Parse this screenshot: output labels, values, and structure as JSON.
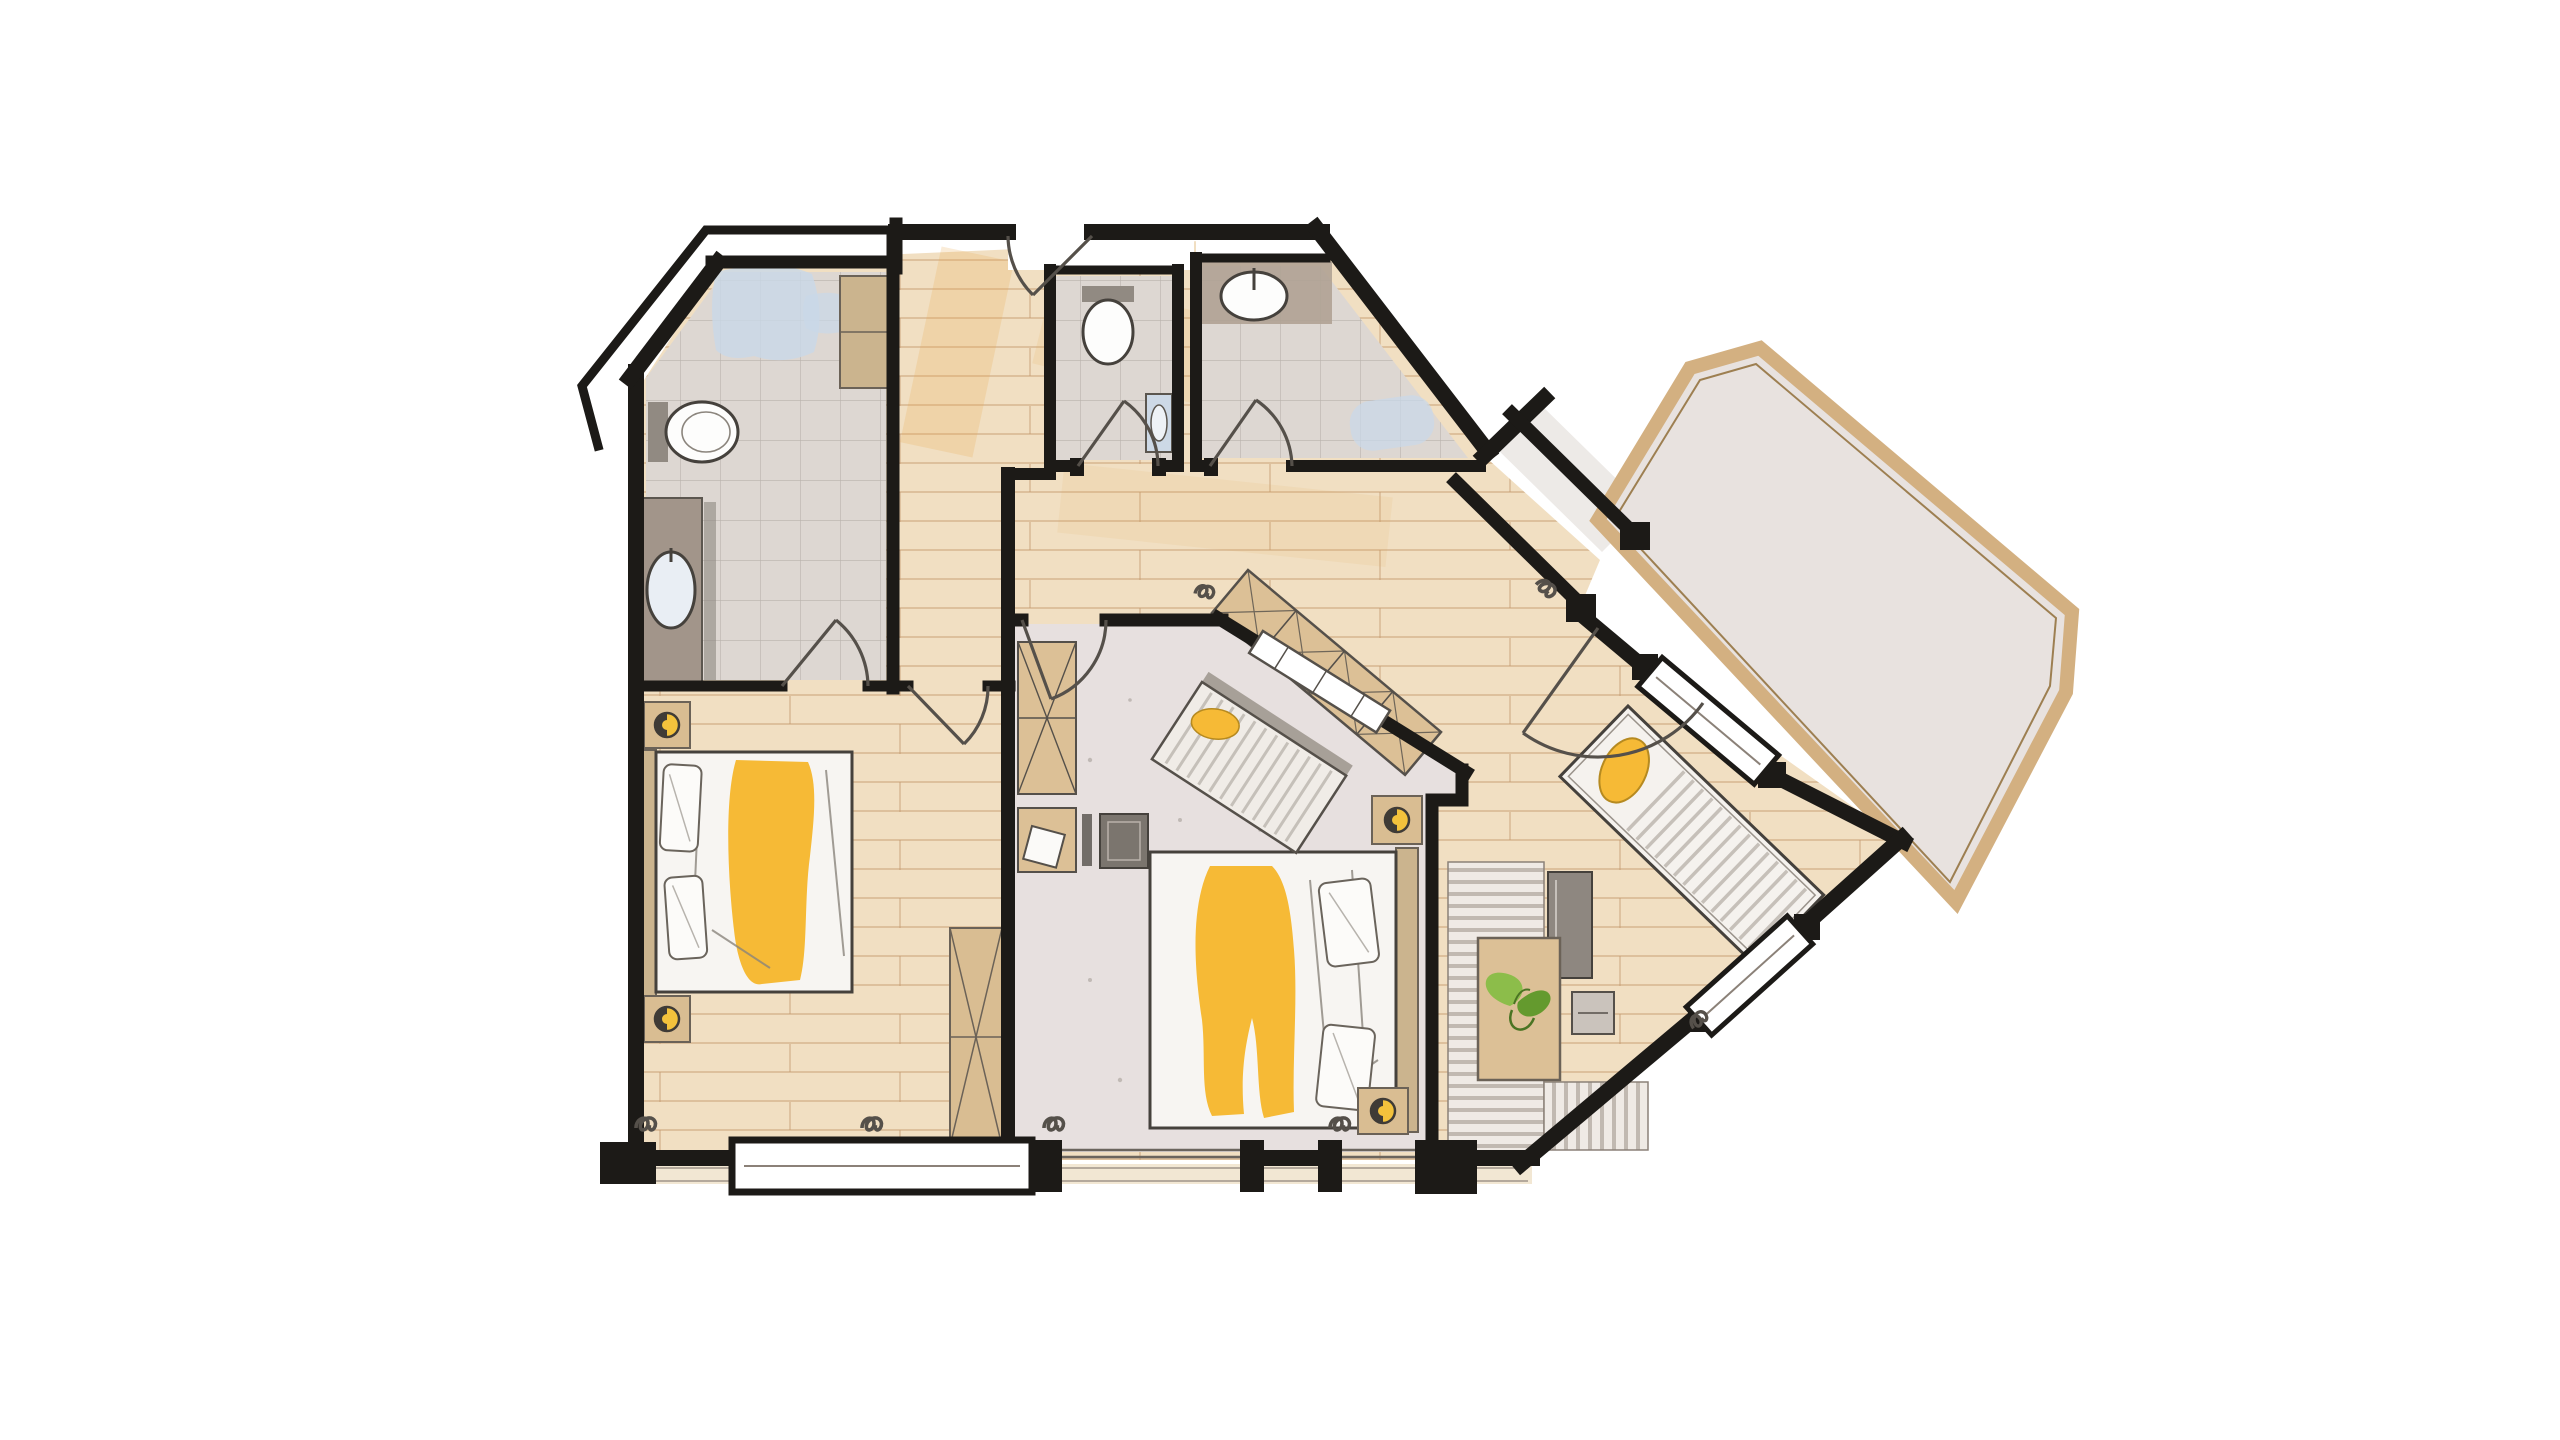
{
  "canvas": {
    "width": 2560,
    "height": 1440
  },
  "palette": {
    "canvas": "#ffffff",
    "wall": "#1c1a17",
    "sketch": "#55504a",
    "wood_base": "#f1dfc2",
    "wood_line": "#c49a6c",
    "wood_warm": "#e6a94f",
    "tile_base": "#ddd7d2",
    "tile_line": "#8f867e",
    "room_floor": "#e7e0df",
    "corridor_floor": "#edeae7",
    "terrace_fill": "#e8e2df",
    "terrace_border": "#d3b081",
    "sill_tan": "#e8d4ae",
    "furniture_tan": "#dcc096",
    "furniture_wood": "#cbb48e",
    "furniture_gray": "#8e8780",
    "rug_base": "#efeae5",
    "rug_stripe": "#b5aca4",
    "mattress": "#f7f5f2",
    "pillow": "#fcfbf9",
    "accent_yellow": "#f6ba36",
    "lamp_yellow": "#f3c23c",
    "plant_green": "#8cbd4a",
    "plant_green_dark": "#649a2e",
    "water_blue": "#c9d8e8",
    "fixture_white": "#fdfdfc",
    "fixture_gray": "#918a82"
  },
  "legend": {
    "rooms": [
      {
        "id": "bathroom-main",
        "kind": "bathroom"
      },
      {
        "id": "wc",
        "kind": "toilet-room"
      },
      {
        "id": "shower-bath",
        "kind": "bathroom"
      },
      {
        "id": "entry-hall",
        "kind": "hallway"
      },
      {
        "id": "bedroom-west",
        "kind": "bedroom"
      },
      {
        "id": "bedroom-middle",
        "kind": "bedroom"
      },
      {
        "id": "lounge",
        "kind": "living-area"
      },
      {
        "id": "terrace-corridor",
        "kind": "corridor"
      },
      {
        "id": "terrace",
        "kind": "terrace"
      }
    ],
    "furniture": [
      "double-bed-west",
      "double-bed-middle",
      "nightstands-with-lamps",
      "wardrobe-x-boxes",
      "hall-wardrobe-diagonal",
      "bench-daybed",
      "sun-lounger",
      "desk-with-chair",
      "sideboard",
      "rug-striped",
      "plant-table",
      "stool",
      "toilets",
      "sinks",
      "vanity",
      "bathtub-wash"
    ]
  }
}
